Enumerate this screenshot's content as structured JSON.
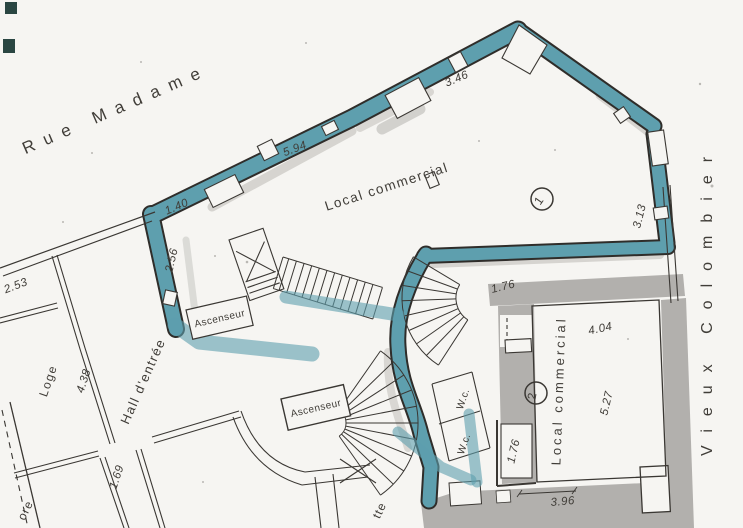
{
  "plan": {
    "streets": {
      "top": "Rue Madame",
      "right": "Vieux Colombier"
    },
    "rooms": {
      "local1_label": "Local commercial",
      "local1_number": "1",
      "local2_label": "Local commercial",
      "local2_number": "2",
      "hall_label": "Hall d'entrée",
      "loge_label": "Loge",
      "elevator1_label": "Ascenseur",
      "elevator2_label": "Ascenseur",
      "wc1_label": "W.c.",
      "wc2_label": "W.c.",
      "partial_bottom_label": "tte",
      "partial_left_label": "ore"
    },
    "dimensions": {
      "facade_upper": "5.94",
      "facade_peak": "3.46",
      "corner_left": "1.40",
      "wall_left": "2.56",
      "room_top_left": "2.53",
      "loge_wall": "4.38",
      "corridor_left": "1.69",
      "local2_door_top": "1.76",
      "local2_door_bottom": "1.76",
      "local2_width": "4.04",
      "local2_depth": "5.27",
      "facade_right": "3.13",
      "facade_bottom": "3.96"
    },
    "colors": {
      "highlight_teal": "#5e9fae",
      "wall_gray": "#b2b0ad",
      "ink": "#3a3733",
      "paper": "#f6f5f2"
    }
  }
}
